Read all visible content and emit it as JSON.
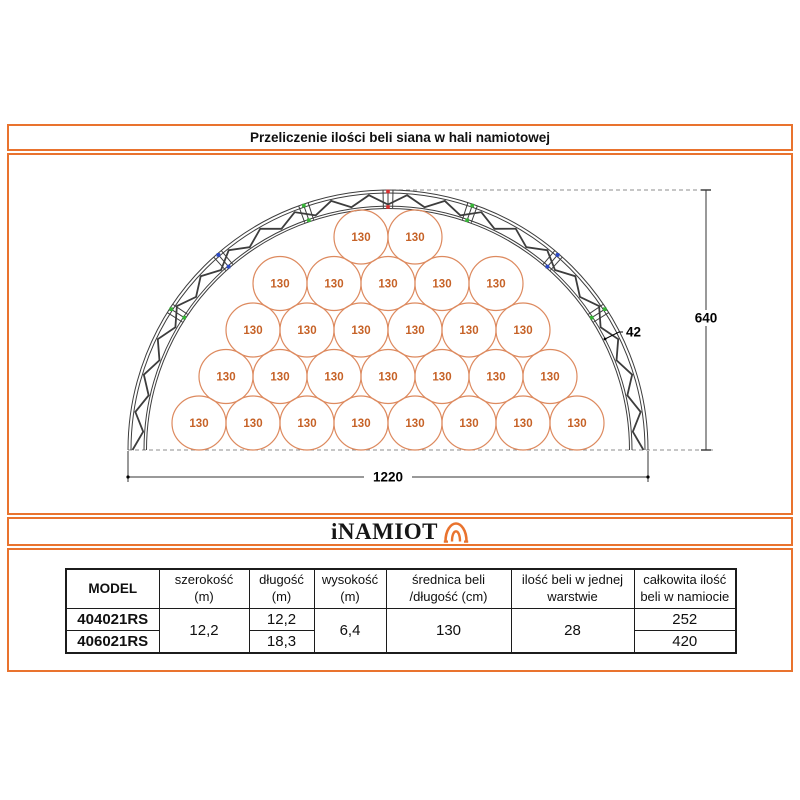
{
  "title": "Przeliczenie ilości beli siana w hali namiotowej",
  "logo": {
    "text": "iNAMIOT",
    "icon": "tent-icon",
    "color": "#e9732e"
  },
  "accent_color": "#e9732e",
  "diagram": {
    "description": "Cross-section of arched tent hall filled with round hay bales",
    "bale_label": "130",
    "bale_rows_top_to_bottom": [
      2,
      5,
      6,
      7,
      8
    ],
    "total_bales_per_layer": 28,
    "dimensions": {
      "width_cm": "1220",
      "height_cm": "640",
      "truss_cm": "42"
    },
    "colors": {
      "bale_stroke": "#dd8a5f",
      "bale_text": "#c66227",
      "truss": "#3d3d3d",
      "dashed": "#8c8c8c",
      "dimension_text": "#000000",
      "marker_red": "#d93030",
      "marker_green": "#36b336",
      "marker_blue": "#2b49c8"
    }
  },
  "table": {
    "columns": [
      {
        "line1": "MODEL",
        "line2": ""
      },
      {
        "line1": "szerokość",
        "line2": "(m)"
      },
      {
        "line1": "długość",
        "line2": "(m)"
      },
      {
        "line1": "wysokość",
        "line2": "(m)"
      },
      {
        "line1": "średnica beli",
        "line2": "/długość (cm)"
      },
      {
        "line1": "ilość beli w jednej",
        "line2": "warstwie"
      },
      {
        "line1": "całkowita ilość",
        "line2": "beli w namiocie"
      }
    ],
    "rows": {
      "model1": "404021RS",
      "model2": "406021RS",
      "szerokosc": "12,2",
      "dlugosc1": "12,2",
      "dlugosc2": "18,3",
      "wysokosc": "6,4",
      "srednica": "130",
      "ilosc_w_warstwie": "28",
      "calkowita1": "252",
      "calkowita2": "420"
    }
  }
}
